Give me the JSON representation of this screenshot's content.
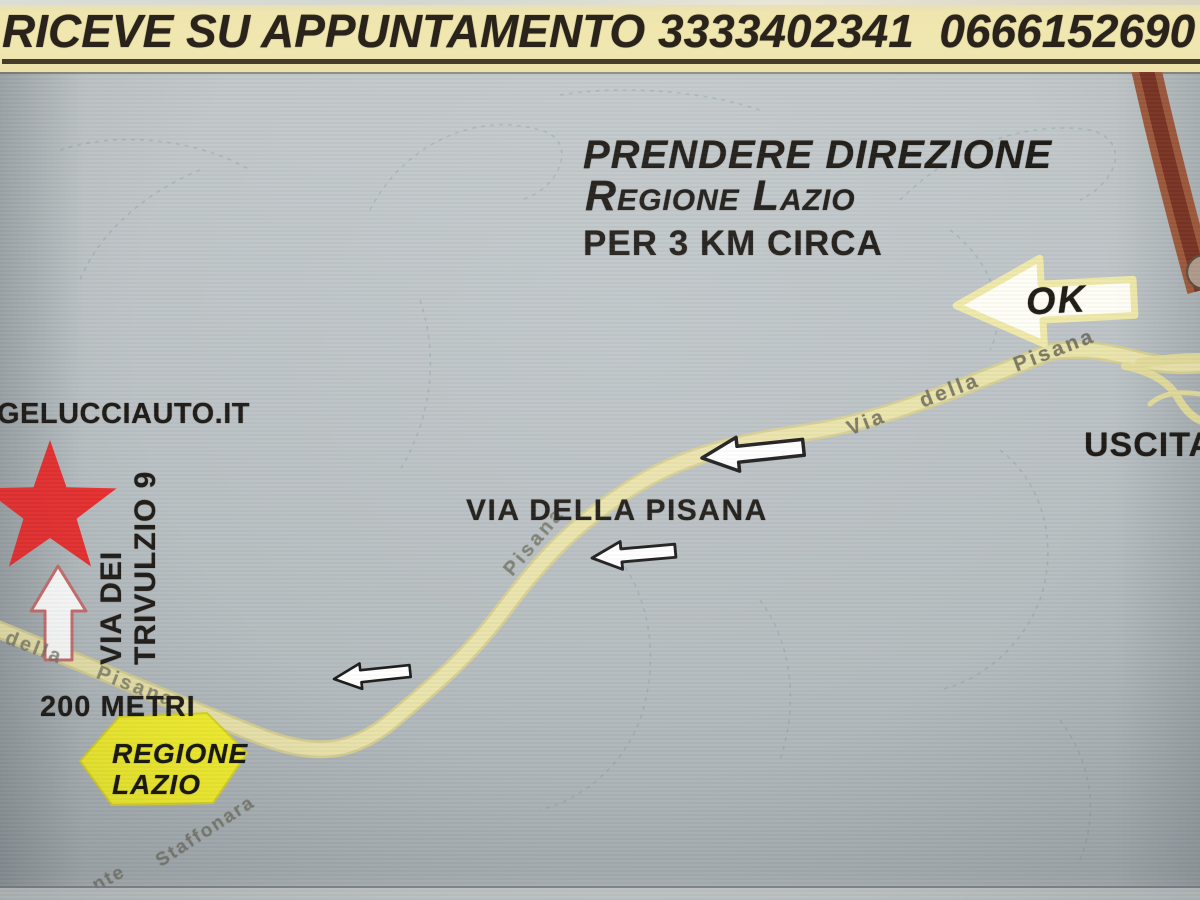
{
  "header": {
    "appointment_text": "RICEVE SU APPUNTAMENTO 3333402341  0666152690"
  },
  "map": {
    "directions": {
      "line1": "PRENDERE DIREZIONE",
      "line2": "Regione Lazio",
      "line3": "PER 3 KM CIRCA"
    },
    "ok_label": "OK",
    "exit_label": "USCITA",
    "website_label": "GELUCCIAUTO.IT",
    "street_sign": {
      "line1": "VIA DEI",
      "line2": "TRIVULZIO 9"
    },
    "distance_label": "200 METRI",
    "regione_sign": {
      "line1": "REGIONE",
      "line2": "LAZIO"
    },
    "main_road_label": "VIA DELLA PISANA",
    "faint_labels": {
      "pisana_upper": "Via  della  Pisana",
      "pisana_left": "della  Pisana",
      "pisana_mid": "Pisana",
      "staffonara": "Staffonara",
      "fragment": "nte"
    },
    "colors": {
      "banner_bg": "#efe5ad",
      "map_bg": "#b8bfc2",
      "road_yellow": "#e9e2a6",
      "highway_red": "#8a4029",
      "star_red": "#e93030",
      "sign_yellow": "#f3ef2d",
      "ink": "#1e1b17"
    }
  }
}
